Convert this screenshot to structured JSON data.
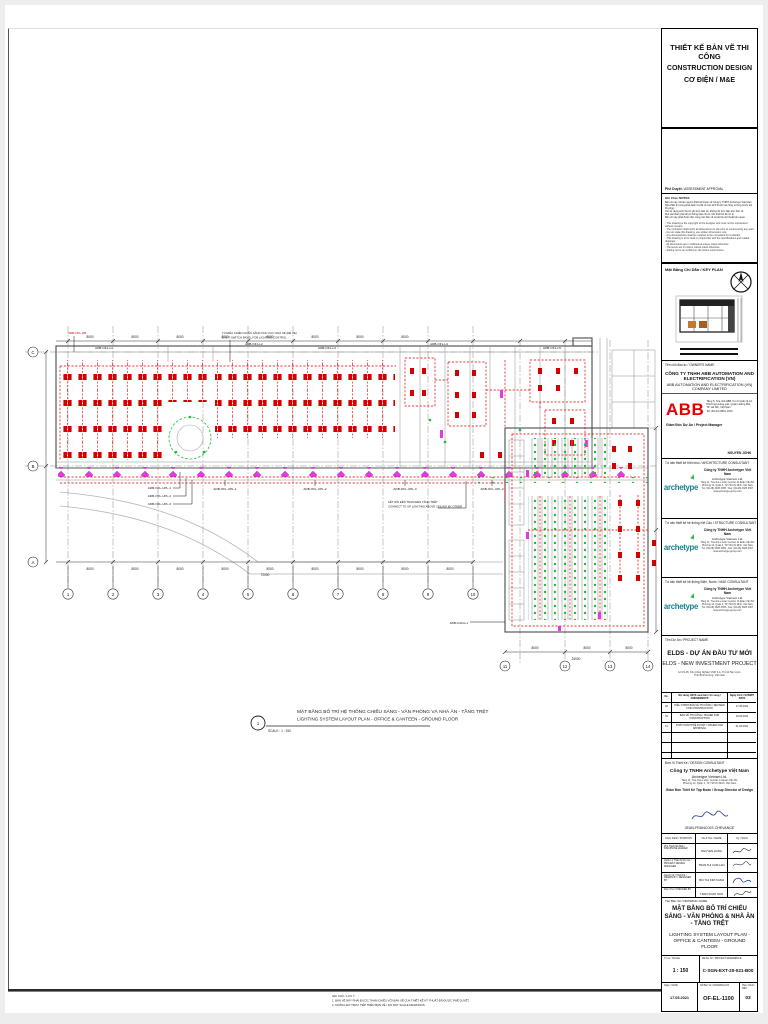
{
  "titleblock": {
    "header": {
      "l1": "THIẾT KẾ BẢN VẼ THI CÔNG",
      "l2": "CONSTRUCTION DESIGN",
      "l3": "CƠ ĐIỆN  / M&E"
    },
    "approval_vi": "Phê Duyệt",
    "approval_en": " / ASSESSMENT APPROVAL",
    "notes_label": "Ghi Chú / NOTES",
    "notes_vi": [
      "Bản vẽ này và bản quyền thiết kế thuộc về Công ty TNHH Archetype Việt Nam.",
      "Nhà thầu thi công phải kiểm tra tất cả các kích thước tại công trường trước khi thi công.",
      "Chỉ sử dụng kích thước ghi trên bản vẽ, không đo trực tiếp trên bản vẽ.",
      "Mọi sai khác phải được thông báo cho tư vấn thiết kế để xử lý.",
      "Bản vẽ này phải được đọc cùng các bản vẽ và tài liệu kỹ thuật liên quan."
    ],
    "notes_en": [
      "- This drawing is the copyright of the designer and must not be reproduced without consent.",
      "- The contractor shall verify all dimensions on site prior to commencing any work.",
      "- Do not scale this drawing, use written dimensions only.",
      "- Any discrepancies shall be reported to the consultant for resolution.",
      "- This drawing is to be read in conjunction with the specifications and related drawings.",
      "- All dimensions are in millimetres unless noted otherwise.",
      "- The levels are in metres unless noted otherwise.",
      "- Setting out to be verified on site before construction."
    ],
    "keyplan_label": "Mặt Bằng Chỉ Dẫn / KEY PLAN",
    "owner": {
      "label": "Tên chủ đầu tư / OWNER'S NAME",
      "company_vi": "CÔNG TY TNHH ABB AUTOMATION AND ELECTRIFICATION (VN)",
      "company_en": "ABB AUTOMATION AND ELECTRIFICATION (VN) COMPANY LIMITED",
      "logo": "ABB",
      "addr1": "Tầng 5, Tòa nhà ABB, Km 9 Quốc lộ 1A,",
      "addr2": "Phường Hoàng Liệt, Quận Hoàng Mai,",
      "addr3": "TP. Hà Nội, Việt Nam",
      "addr4": "Tel: (84-24) 3861 1010",
      "role": "Giám Đốc Dự Án / Project Manager",
      "sign": "NGUYEN JOHN"
    },
    "consultants": [
      {
        "label": "Tư vấn thiết kế Kiến trúc / ARCHITECTURE CONSULTANT",
        "logo": "archetype",
        "company_vi": "Công ty TNHH Archetype Việt Nam",
        "company_en": "Archetype Vietnam Ltd.",
        "addr1": "Tầng 11, Tòa nhà e.town Central, 11 Đoàn Văn Bơ",
        "addr2": "Phường 12, Quận 4, TP. Hồ Chí Minh, Việt Nam",
        "tel": "Tel: (84-28) 3925 3365 - Fax: (84-28) 3925 3367",
        "web": "www.archetype-group.com"
      },
      {
        "label": "Tư vấn thiết kế hệ thống Kết Cấu / STRUCTURE CONSULTANT",
        "logo": "archetype",
        "company_vi": "Công ty TNHH Archetype Việt Nam",
        "company_en": "Archetype Vietnam Ltd.",
        "addr1": "Tầng 11, Tòa nhà e.town Central, 11 Đoàn Văn Bơ",
        "addr2": "Phường 12, Quận 4, TP. Hồ Chí Minh, Việt Nam",
        "tel": "Tel: (84-28) 3925 3365 - Fax: (84-28) 3925 3367",
        "web": "www.archetype-group.com"
      },
      {
        "label": "Tư vấn thiết kế hệ thống Điện, Nước / M&E CONSULTANT",
        "logo": "archetype",
        "company_vi": "Công ty TNHH Archetype Việt Nam",
        "company_en": "Archetype Vietnam Ltd.",
        "addr1": "Tầng 11, Tòa nhà e.town Central, 11 Đoàn Văn Bơ",
        "addr2": "Phường 12, Quận 4, TP. Hồ Chí Minh, Việt Nam",
        "tel": "Tel: (84-28) 3925 3365 - Fax: (84-28) 3925 3367",
        "web": "www.archetype-group.com"
      }
    ],
    "project": {
      "label": "Tên Dự Án / PROJECT NAME",
      "name_vi": "ELDS - DỰ ÁN ĐẦU TƯ MỚI",
      "name_en": "ELDS - NEW INVESTMENT PROJECT",
      "addr1": "Lô CN-05, Khu Công Nghiệp VSIP II-A, Thị xã Tân Uyên,",
      "addr2": "Tỉnh Bình Dương, Việt Nam"
    },
    "revisions": {
      "h_no": "No.",
      "h_desc": "Nội dung HSTK xuất bản / bổ sung / AMENDMENTS",
      "h_date": "Ngày trình / SUBMIT DATE",
      "rows": [
        {
          "no": "03",
          "desc": "HIỆU CHỈNH BẢN VẼ THI CÔNG / REVISED FOR CONSTRUCTION",
          "date": "17.05.2021"
        },
        {
          "no": "02",
          "desc": "BẢN VẼ THI CÔNG / ISSUED FOR CONSTRUCTION",
          "date": "19.03.2021"
        },
        {
          "no": "01",
          "desc": "PHÁT HÀNH PHÊ DUYỆT / ISSUED FOR APPROVAL",
          "date": "01.03.2021"
        }
      ]
    },
    "firm": {
      "label": "Đơn Vị Thiết Kế / DESIGN CONSULTANT",
      "company_vi": "Công ty TNHH Archetype Việt Nam",
      "company_en": "Archetype Vietnam Ltd.",
      "addr1": "Tầng 11, Tòa nhà e.town Central, 11 Đoàn Văn Bơ",
      "addr2": "Phường 12, Quận 4, TP. Hồ Chí Minh, Việt Nam",
      "role": "Giám Đốc Thiết Kế Tập Đoàn / Group Director of Design",
      "sign": "JEAN-FRANCOIS CHEVANCE"
    },
    "sign_headers": {
      "c1": "Chức Danh / POSITION",
      "c2": "Họ & Tên / NAME",
      "c3": "Ký / SIGN"
    },
    "signoff": [
      {
        "label": "Phụ Trách Bộ Môn / DISCIPLINE LEADER",
        "name": "NGUYEN HUNG"
      },
      {
        "label": "Quản Lý Thiết Kế Dự Án / PROJECT DESIGN MANAGER",
        "name": "TRAN THI CAM LAN"
      },
      {
        "label": "Người Vẽ / Thiết Kế / DRAWN BY / DESIGNED BY",
        "name": "BUI THI KIM OANH"
      },
      {
        "label": "Kiểm Tra / CHECKED BY",
        "name": "TRAN XUAN SON"
      }
    ],
    "drawing_name": {
      "label": "Tên Bản Vẽ / DRAWING NAME",
      "vi": "MẶT BẰNG BỐ TRÍ CHIẾU SÁNG - VĂN PHÒNG & NHÀ ĂN - TẦNG TRỆT",
      "en": "LIGHTING SYSTEM LAYOUT PLAN - OFFICE & CANTEEN - GROUND FLOOR"
    },
    "footer": {
      "scale_l": "Tỷ Lệ / SCALE",
      "scale_v": "1 : 150",
      "ref_l": "Mã Dự Án / PROJECT REFERENCE",
      "ref_v": "C-SGN-EXT-20-021-B00",
      "date_l": "Ngày / DATE",
      "date_v": "17.05.2021",
      "no_l": "Số Bản Vẽ / DRAWING NO.",
      "no_v": "OF-EL-1100",
      "rev_l": "Hiệu Chỉnh / REV.",
      "rev_v": "03"
    }
  },
  "drawing": {
    "title_vi": "MẶT BẰNG BỐ TRÍ HỆ THỐNG CHIẾU SÁNG - VĂN PHÒNG VÀ NHÀ ĂN - TẦNG TRỆT",
    "title_en": "LIGHTING SYSTEM LAYOUT PLAN - OFFICE & CANTEEN - GROUND FLOOR",
    "viewnum": "1",
    "scale_note": "SCALE : 1 : 150",
    "note_top": [
      "TỦ ĐIỀU KHIỂN CHIẾU SÁNG KHU VỰC NHÀ XE (ĐỂ XE)",
      "LIGHT SWITCH PANEL FOR LIGHTING CONTROL"
    ],
    "note_mid": [
      "KẾT NỐI ĐẾN TRẠM ĐÈN TẦNG TRỆT",
      "CONNECT TO UP LIGHTING ABOVE CEILING BY OTHER"
    ],
    "labels": {
      "db": "ADB-OFL-DB",
      "l1": "ADB-OFL-L1",
      "l2": "ADB-OFL-L2",
      "l3": "ADB-OFL-L3",
      "l4": "ADB-OFL-L4",
      "l5": "ADB-OFL-L5",
      "upl1": "ADB-OFL-UPL-1",
      "upl2": "ADB-OFL-UPL-2",
      "upl3": "ADB-OFL-UPL-3",
      "upl4": "ADB-OFL-UPL-4",
      "cl1": "ADB-CAN-L1"
    },
    "dim_value": "8000",
    "dim_total_office": "72000",
    "dim_total_canteen": "24000",
    "grid_cols": [
      "1",
      "2",
      "3",
      "4",
      "5",
      "6",
      "7",
      "8",
      "9",
      "10"
    ],
    "grid_cols2": [
      "11",
      "12",
      "13",
      "14"
    ],
    "grid_rows": [
      "C",
      "B",
      "A"
    ],
    "bottom_note": [
      "GHI CHÚ / LƯU Ý:",
      "1. BẢN VẼ NÀY PHẢI ĐƯỢC THAM CHIẾU VỚI BẢN VẼ CỦA THIẾT KẾ KỸ THUẬT ĐÃ ĐƯỢC PHÊ DUYỆT.",
      "2. KHÔNG ĐO TRỰC TIẾP TRÊN BẢN VẼ / DO NOT SCALE DRAWINGS."
    ]
  }
}
